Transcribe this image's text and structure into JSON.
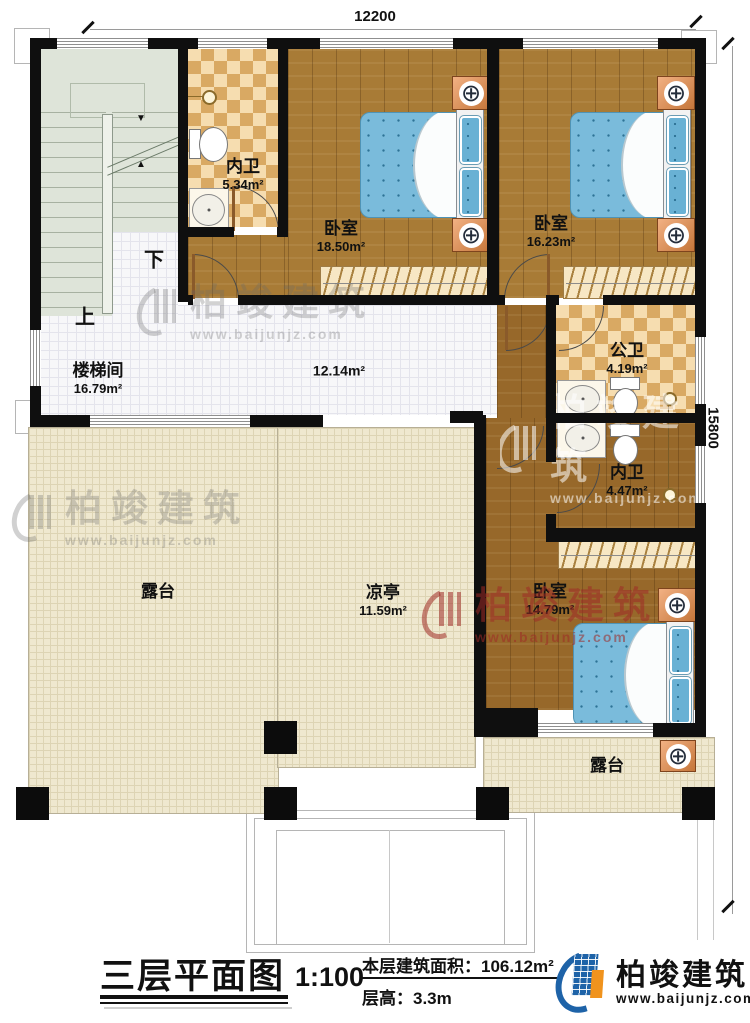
{
  "dimensions": {
    "width_top": "12200",
    "height_right": "15800"
  },
  "stairs": {
    "down": "下",
    "up": "上"
  },
  "rooms": {
    "stairwell": {
      "name": "楼梯间",
      "area": "16.79m²"
    },
    "bath_top": {
      "name": "内卫",
      "area": "5.34m²"
    },
    "bedroom_left": {
      "name": "卧室",
      "area": "18.50m²"
    },
    "bedroom_right": {
      "name": "卧室",
      "area": "16.23m²"
    },
    "corridor": {
      "area": "12.14m²"
    },
    "bath_public": {
      "name": "公卫",
      "area": "4.19m²"
    },
    "bath_inner": {
      "name": "内卫",
      "area": "4.47m²"
    },
    "bedroom_bottom": {
      "name": "卧室",
      "area": "14.79m²"
    },
    "terrace_left": {
      "name": "露台"
    },
    "pavilion": {
      "name": "凉亭",
      "area": "11.59m²"
    },
    "terrace_right": {
      "name": "露台"
    }
  },
  "watermark": {
    "name": "柏竣建筑",
    "url": "www.baijunjz.com"
  },
  "footer": {
    "title": "三层平面图",
    "scale": "1:100",
    "area_label": "本层建筑面积：",
    "area_value": "106.12m²",
    "floor_height_label": "层高：",
    "floor_height_value": "3.3m"
  },
  "brand": {
    "name": "柏竣建筑",
    "url": "www.baijunjz.com"
  },
  "icons": {
    "nightstand_ornament": "⊕",
    "stair_arrow_down": "▼",
    "stair_arrow_up": "▲"
  },
  "colors": {
    "wall": "#0f0f0f",
    "wood_floor": "#a87b36",
    "tile_light": "#f6ddb0",
    "tile_dark": "#d9a963",
    "stair": "#dee4d9",
    "terrace": "#efe8cf",
    "bed_blue": "#7abbdb",
    "nightstand_orange": "#e0915c",
    "brand_blue": "#1e63a8",
    "brand_orange": "#f0931d",
    "watermark_red": "#9e2a26"
  }
}
